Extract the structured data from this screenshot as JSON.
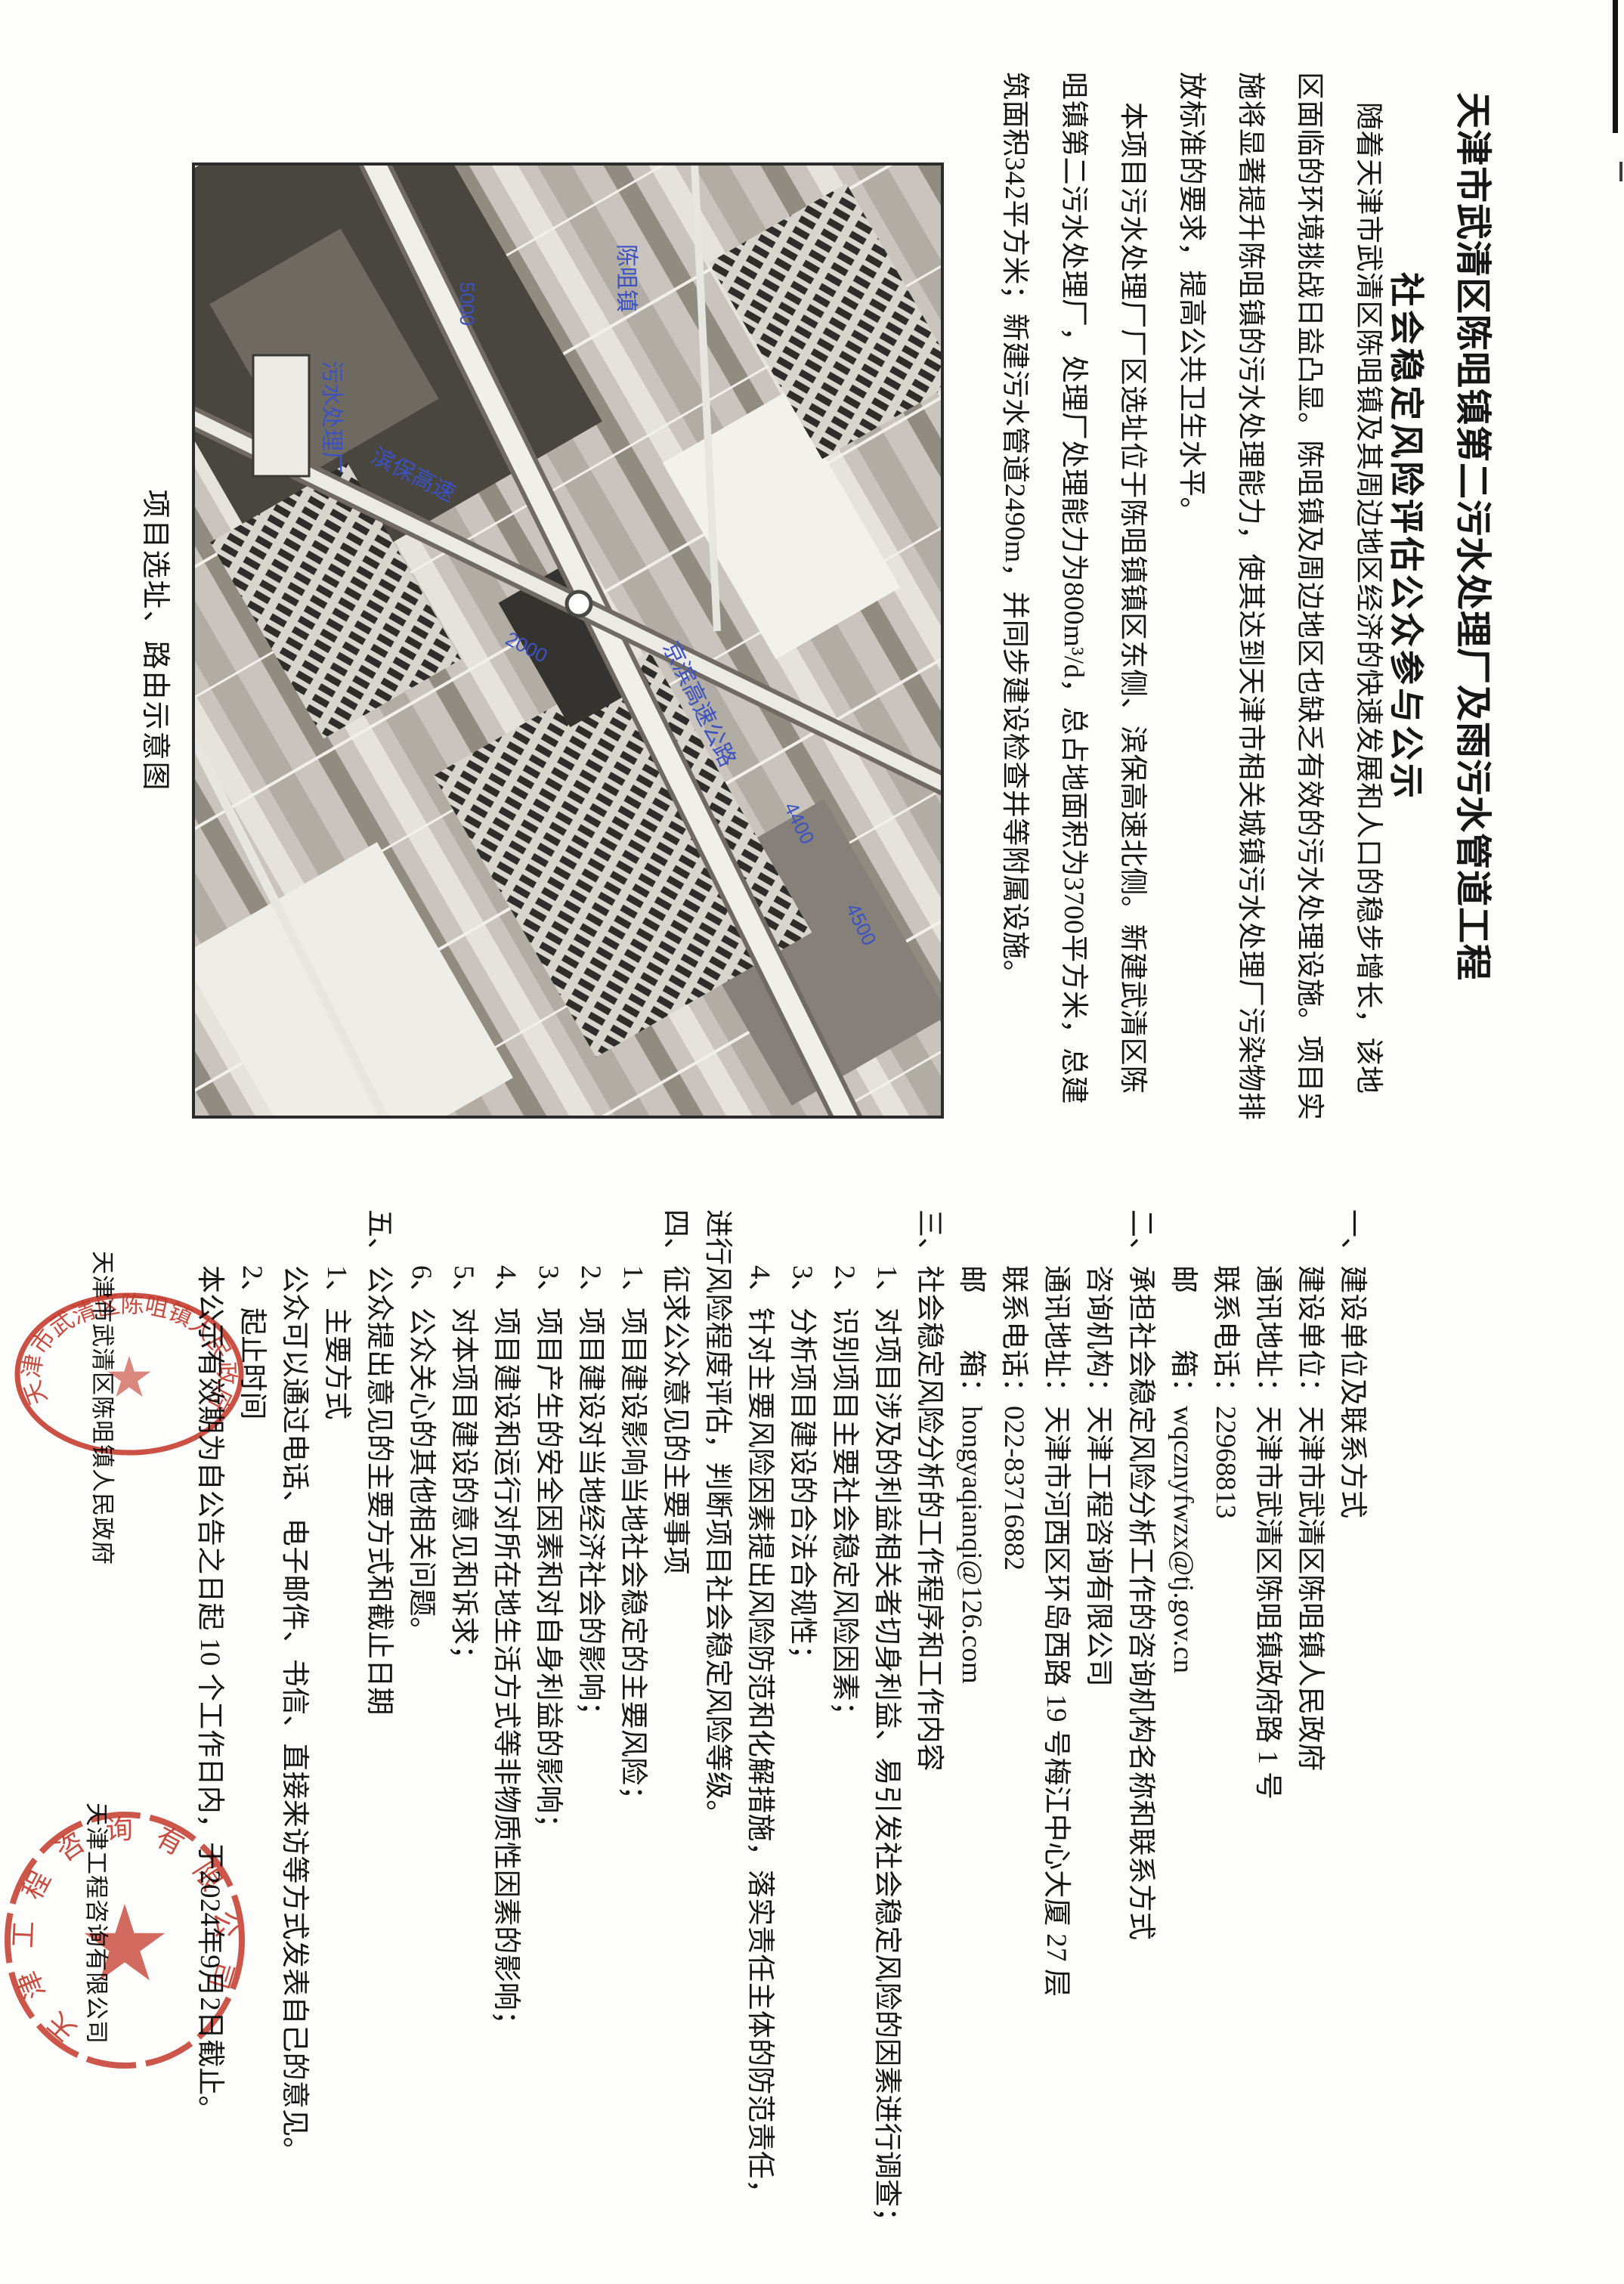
{
  "document": {
    "title_line1": "天津市武清区陈咀镇第二污水处理厂及雨污水管道工程",
    "title_line2": "社会稳定风险评估公众参与公示"
  },
  "intro": {
    "lines": [
      "随着天津市武清区陈咀镇及其周边地区经济的快速发展和人口的稳步增长，该地",
      "区面临的环境挑战日益凸显。陈咀镇及周边地区也缺乏有效的污水处理设施。项目实",
      "施将显著提升陈咀镇的污水处理能力，使其达到天津市相关城镇污水处理厂污染物排",
      "放标准的要求，提高公共卫生水平。",
      "本项目污水处理厂厂区选址位于陈咀镇镇区东侧、滨保高速北侧。新建武清区陈",
      "咀镇第二污水处理厂，处理厂处理能力为800m³/d，总占地面积为3700平方米，总建",
      "筑面积342平方米；新建污水管道2490m，并同步建设检查井等附属设施。"
    ]
  },
  "map": {
    "caption": "项目选址、路由示意图",
    "labels": {
      "highway_main": "京滨高速公路",
      "highway_south": "滨保高速",
      "plant_site": "污水处理厂",
      "town": "陈咀镇",
      "dim1": "4400",
      "dim2": "4500",
      "dim3": "2000",
      "dim4": "5000"
    }
  },
  "notice": {
    "lines": [
      "一、建设单位及联系方式",
      "建设单位：天津市武清区陈咀镇人民政府",
      "通讯地址：天津市武清区陈咀镇政府路 1 号",
      "联系电话：22968813",
      "邮　　箱：wqcznyfwzx@tj.gov.cn",
      "二、承担社会稳定风险分析工作的咨询机构名称和联系方式",
      "咨询机构：天津工程咨询有限公司",
      "通讯地址：天津市河西区环岛西路 19 号梅江中心大厦 27 层",
      "联系电话：022-83716882",
      "邮　　箱：hongyaqianqi@126.com",
      "三、社会稳定风险分析的工作程序和工作内容",
      "1、对项目涉及的利益相关者切身利益、易引发社会稳定风险的因素进行调查；",
      "2、识别项目主要社会稳定风险因素；",
      "3、分析项目建设的合法合规性；",
      "4、针对主要风险因素提出风险防范和化解措施，落实责任主体的防范责任，",
      "进行风险程度评估，判断项目社会稳定风险等级。",
      "四、征求公众意见的主要事项",
      "1、项目建设影响当地社会稳定的主要风险；",
      "2、项目建设对当地经济社会的影响；",
      "3、项目产生的安全因素和对自身利益的影响；",
      "4、项目建设和运行对所在地生活方式等非物质性因素的影响；",
      "5、对本项目建设的意见和诉求；",
      "6、公众关心的其他相关问题。",
      "五、公众提出意见的主要方式和截止日期",
      "1、主要方式",
      "公众可以通过电话、电子邮件、书信、直接来访等方式发表自己的意见。",
      "2、起止时间",
      "本公示有效期为自公告之日起 10 个工作日内，于2024年9月2日截止。"
    ]
  },
  "signatures": {
    "government": "天津市武清区陈咀镇人民政府",
    "consultant": "天津工程咨询有限公司"
  },
  "seals": {
    "government_text": "天津市武清区陈咀镇人民政府",
    "consultant_text": "天津工程咨询有限公司"
  },
  "colors": {
    "seal_red": "#c5392b",
    "map_label_blue": "#3b52c0"
  }
}
